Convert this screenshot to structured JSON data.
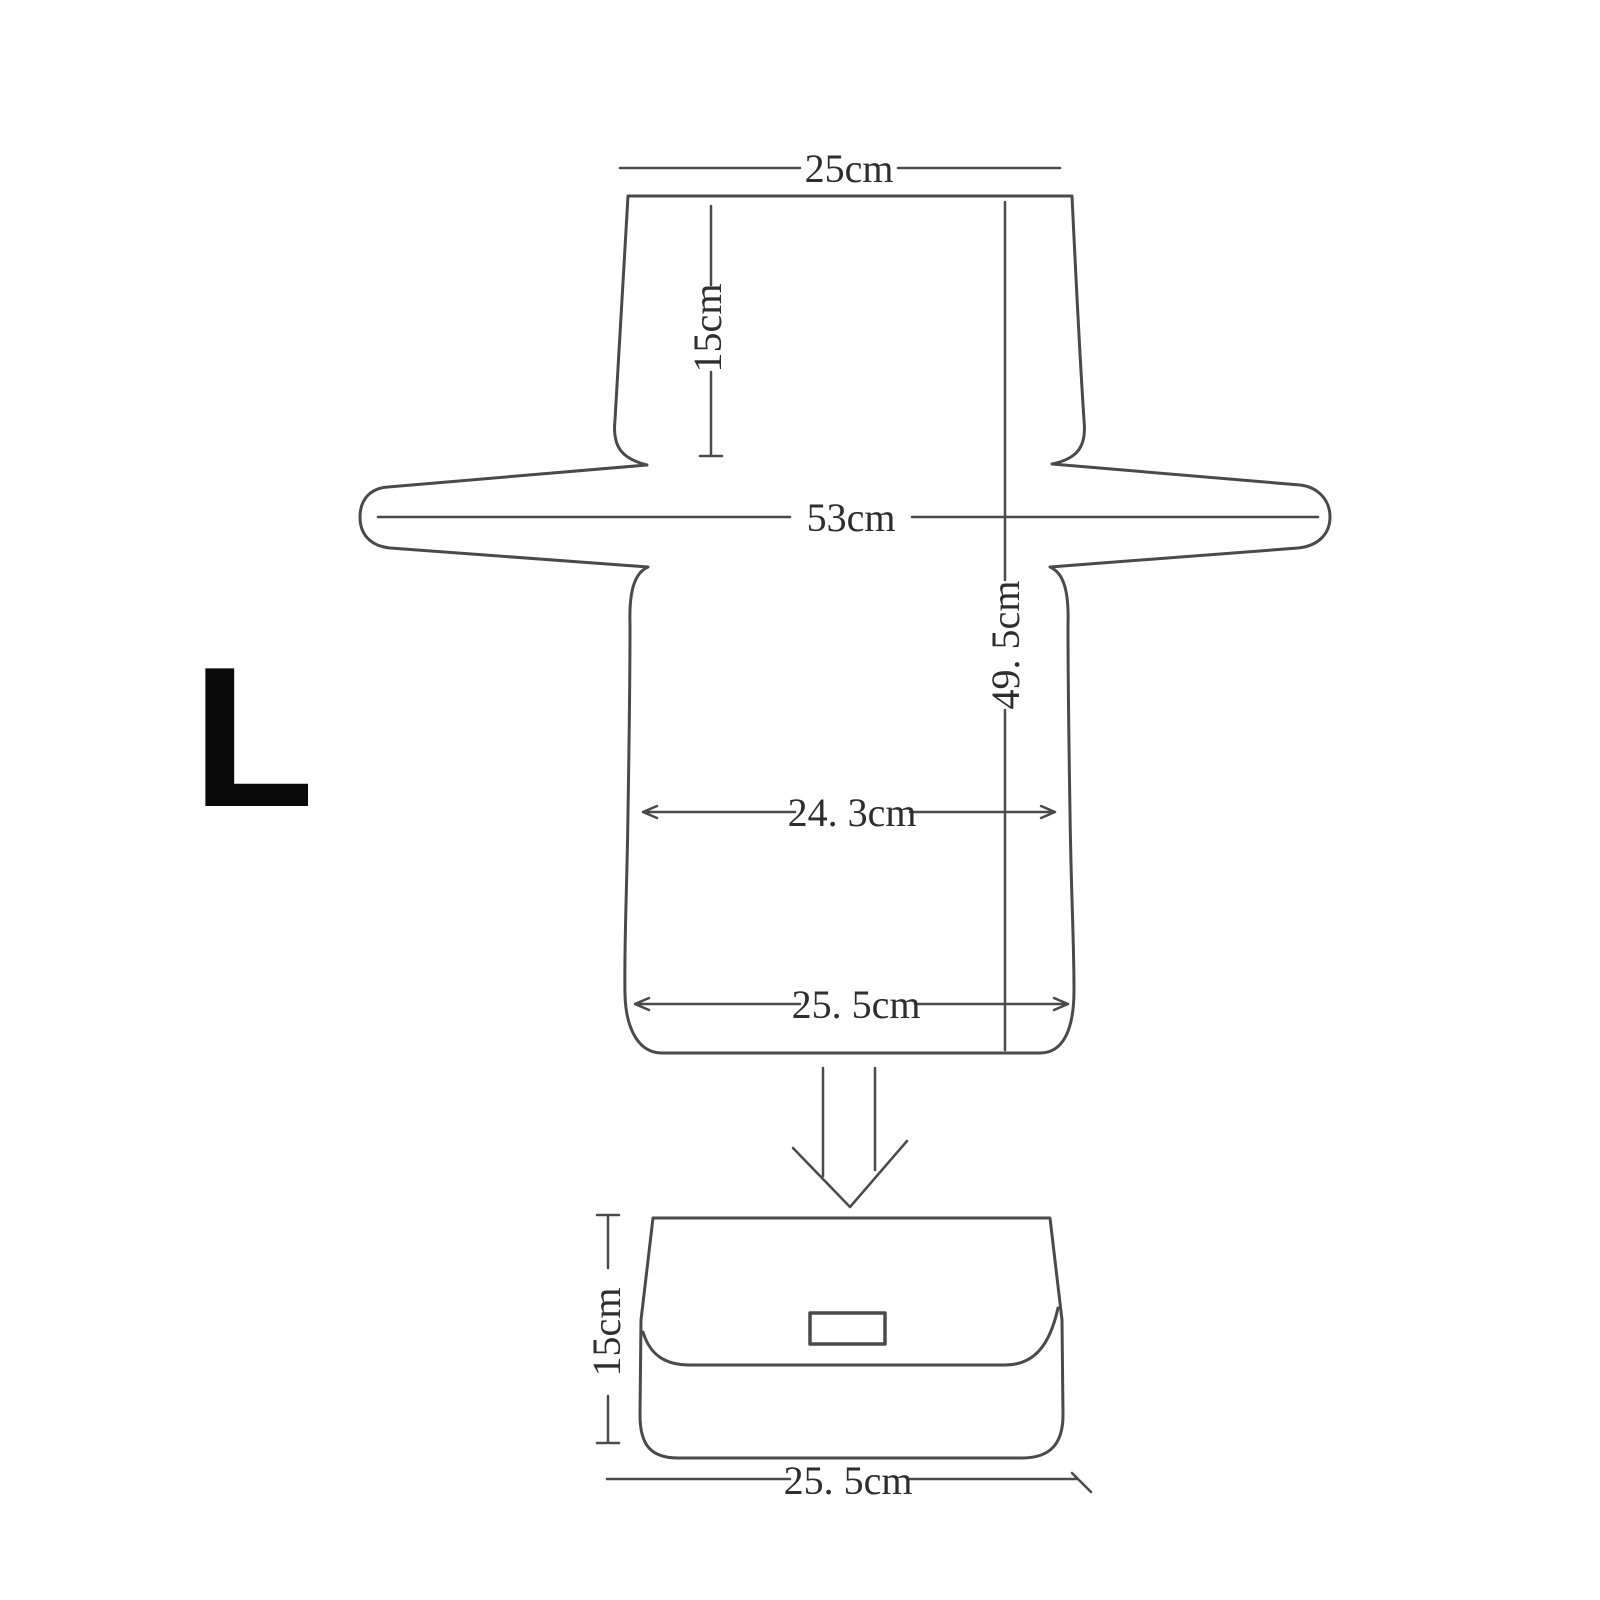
{
  "diagram": {
    "type": "sewing-pattern-dimension-diagram",
    "size_label": "L",
    "unit": "cm",
    "pattern": {
      "top_width": "25cm",
      "upper_height": "15cm",
      "wing_span": "53cm",
      "total_height": "49. 5cm",
      "middle_width": "24. 3cm",
      "bottom_width": "25. 5cm"
    },
    "finished_bag": {
      "height": "15cm",
      "width": "25. 5cm"
    },
    "colors": {
      "line": "#4a4a4a",
      "text": "#2e2e2e",
      "size_letter": "#0a0a0a",
      "background": "#ffffff"
    }
  }
}
